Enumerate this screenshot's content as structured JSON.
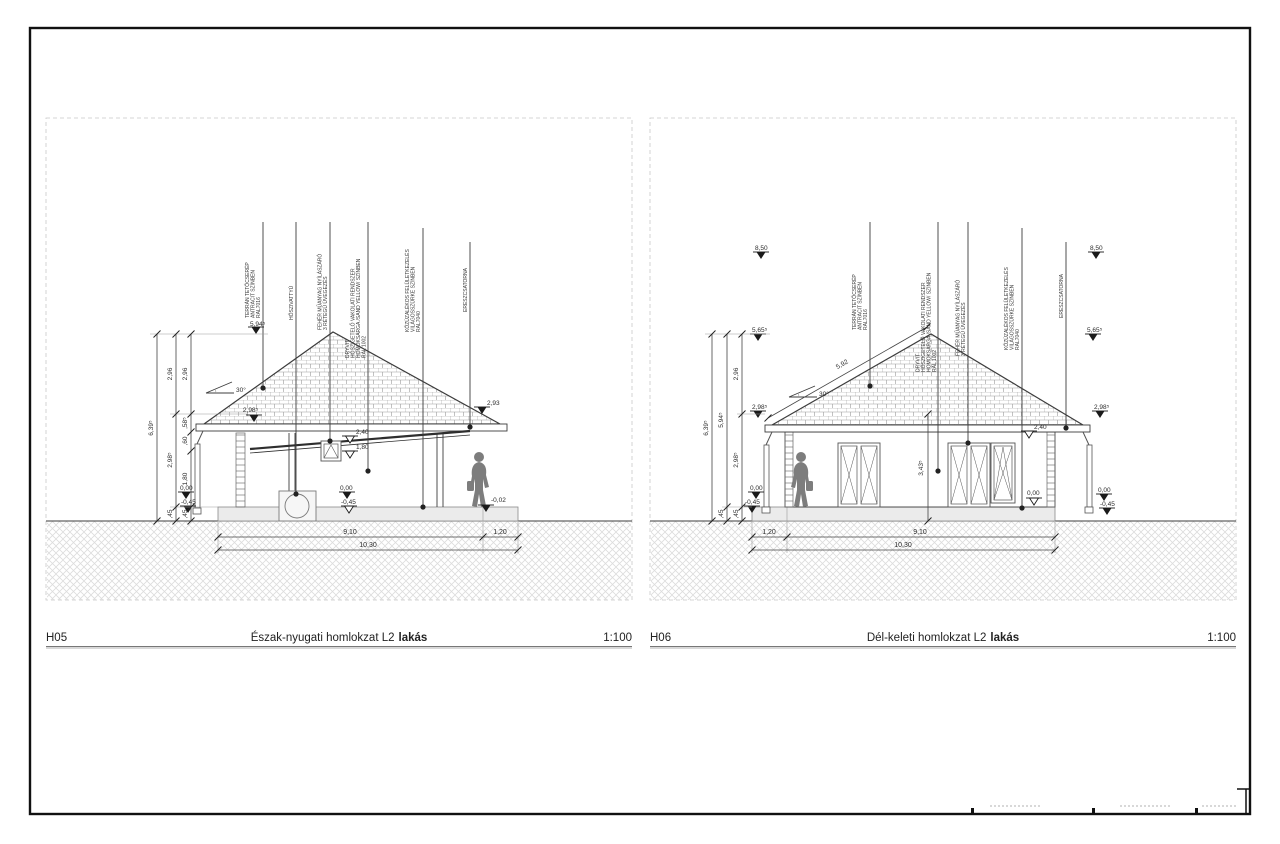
{
  "left": {
    "code": "H05",
    "title": "Észak-nyugati homlokzat L2",
    "title_bold": "lakás",
    "scale": "1:100",
    "slope": "30°",
    "ann": [
      {
        "lines": [
          "TERRÁN TETŐCSERÉP",
          "ANTRACIT SZÍNBEN",
          "RAL7016"
        ]
      },
      {
        "lines": [
          "HŐSZIVATTYÚ"
        ]
      },
      {
        "lines": [
          "FEHÉR MŰANYAG NYÍLÁSZÁRÓ",
          "3 RÉTEGŰ ÜVEGEZÉS"
        ]
      },
      {
        "lines": [
          "DRYVIT",
          "HŐSZIGETELŐ VAKOLATI RENDSZER",
          "HOMOKSÁRGA /SAND YELLOW/ SZÍNBEN",
          "RAL 1002"
        ]
      },
      {
        "lines": [
          "KŐZÚZALÉKOS FELÜLETKEZELÉS",
          "VILÁGOSSZÜRKE SZÍNBEN",
          "RAL7040"
        ]
      },
      {
        "lines": [
          "ERESZCSATORNA"
        ]
      }
    ],
    "levels": {
      "ridge": "5,94⁵",
      "eavesL": "2,98⁵",
      "eavesR": "2,93",
      "head": "2,40",
      "sill": "1,80",
      "zeroL": "0,00",
      "minusL": "-0,45",
      "zeroM": "0,00",
      "minusM": "-0,45",
      "terrace": "-0,02"
    },
    "chains": {
      "total": "6,39⁵",
      "mid": [
        "2,96",
        "2,98⁵",
        ",45"
      ],
      "inner": [
        "2,96",
        ",58⁵",
        ",60",
        "1,80",
        ",45"
      ]
    },
    "widths": {
      "main": "9,10",
      "porch": "1,20",
      "total": "10,30"
    }
  },
  "right": {
    "code": "H06",
    "title": "Dél-keleti homlokzat L2",
    "title_bold": "lakás",
    "scale": "1:100",
    "slope": "30°",
    "slopeLen": "5,92",
    "wallDim": "3,43⁵",
    "ann": [
      {
        "lines": [
          "TERRÁN TETŐCSERÉP",
          "ANTRACIT SZÍNBEN",
          "RAL7016"
        ]
      },
      {
        "lines": [
          "DRYVIT",
          "HŐSZIGETELŐ VAKOLATI RENDSZER",
          "HOMOKSÁRGA /SAND YELLOW/ SZÍNBEN",
          "RAL 1002"
        ]
      },
      {
        "lines": [
          "FEHÉR MŰANYAG NYÍLÁSZÁRÓ",
          "3 RÉTEGŰ ÜVEGEZÉS"
        ]
      },
      {
        "lines": [
          "KŐZÚZALÉKOS FELÜLETKEZELÉS",
          "VILÁGOSSZÜRKE SZÍNBEN",
          "RAL7040"
        ]
      },
      {
        "lines": [
          "ERESZCSATORNA"
        ]
      }
    ],
    "levels": {
      "top": "8,50",
      "upper": "5,65⁵",
      "eaves": "2,98⁵",
      "head": "2,40",
      "zero": "0,00",
      "minus": "-0,45"
    },
    "chains": {
      "total": "6,39⁵",
      "mid": [
        "5,94⁵",
        ",45"
      ],
      "inner": [
        "2,96",
        "2,98⁵",
        ",45"
      ]
    },
    "widths": {
      "porch": "1,20",
      "main": "9,10",
      "total": "10,30"
    }
  }
}
